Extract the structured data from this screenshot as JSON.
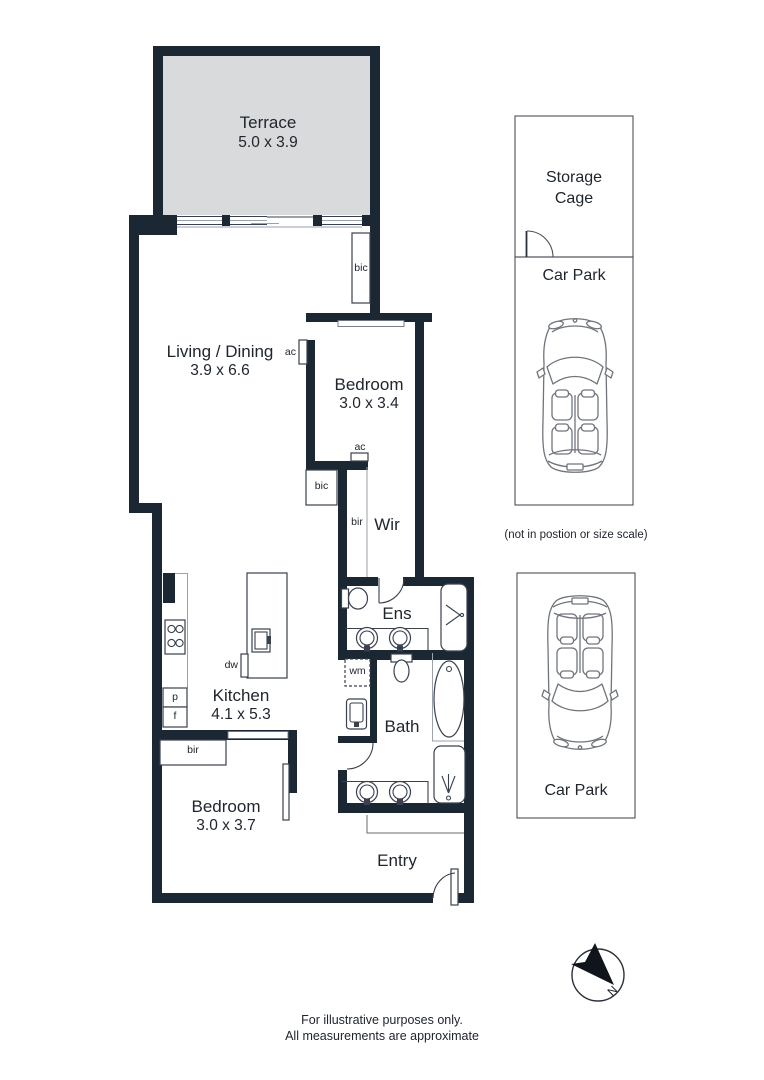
{
  "rooms": {
    "terrace": {
      "name": "Terrace",
      "dims": "5.0 x 3.9"
    },
    "living": {
      "name": "Living / Dining",
      "dims": "3.9 x 6.6"
    },
    "bedroom1": {
      "name": "Bedroom",
      "dims": "3.0 x 3.4"
    },
    "wir": {
      "name": "Wir"
    },
    "ens": {
      "name": "Ens"
    },
    "bath": {
      "name": "Bath"
    },
    "kitchen": {
      "name": "Kitchen",
      "dims": "4.1 x 5.3"
    },
    "bedroom2": {
      "name": "Bedroom",
      "dims": "3.0 x 3.7"
    },
    "entry": {
      "name": "Entry"
    }
  },
  "fixtures": {
    "bic_living": "bic",
    "bic_hall": "bic",
    "bir_wir": "bir",
    "bir_bedroom2": "bir",
    "ac_living": "ac",
    "ac_bedroom": "ac",
    "wm": "wm",
    "dw": "dw",
    "pantry": "p",
    "fridge": "f"
  },
  "parking": {
    "storage_cage": "Storage\nCage",
    "car_park_top": "Car Park",
    "car_park_bottom": "Car Park",
    "note": "(not in postion or size scale)"
  },
  "compass": {
    "north_label": "N"
  },
  "footer": {
    "line1": "For illustrative purposes only.",
    "line2": "All measurements are approximate"
  },
  "colors": {
    "wall": "#1c2734",
    "terrace_fill": "#d9dadc",
    "fixture_line": "#39414e",
    "light_line": "#9aa2ac",
    "car_line": "#70757c",
    "storage_line": "#4b5058",
    "text": "#20262e"
  }
}
